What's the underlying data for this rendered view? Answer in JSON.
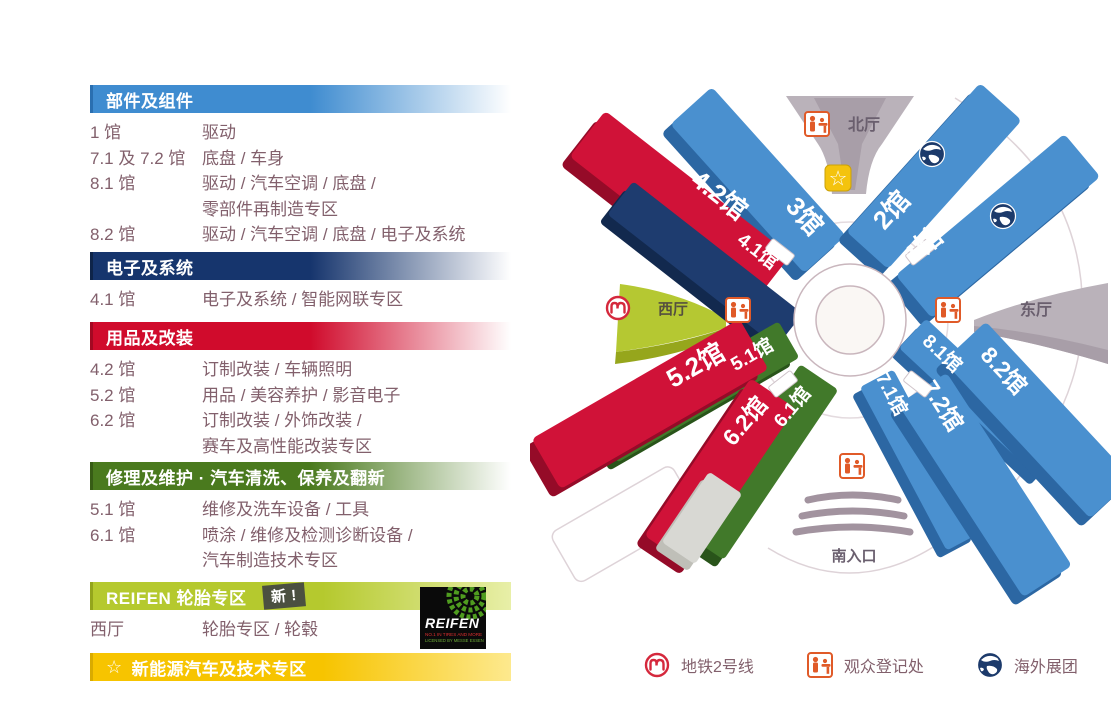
{
  "colors": {
    "blue": "#4a90cf",
    "navy": "#1e3c6f",
    "red": "#d01238",
    "green": "#41792a",
    "lime": "#b5c92e",
    "yellow": "#f7c400",
    "gray_hall": "#bab2ba",
    "body_text": "#82606c"
  },
  "legend": {
    "sections": [
      {
        "title": "部件及组件",
        "rows": [
          {
            "hall": "1 馆",
            "desc": "驱动"
          },
          {
            "hall": "7.1 及 7.2 馆",
            "desc": "底盘 / 车身"
          },
          {
            "hall": "8.1 馆",
            "desc": "驱动 / 汽车空调 / 底盘 /",
            "desc2": "零部件再制造专区"
          },
          {
            "hall": "8.2 馆",
            "desc": "驱动 / 汽车空调 / 底盘 / 电子及系统"
          }
        ]
      },
      {
        "title": "电子及系统",
        "rows": [
          {
            "hall": "4.1 馆",
            "desc": "电子及系统 / 智能网联专区"
          }
        ]
      },
      {
        "title": "用品及改装",
        "rows": [
          {
            "hall": "4.2 馆",
            "desc": "订制改装 / 车辆照明"
          },
          {
            "hall": "5.2 馆",
            "desc": "用品 / 美容养护 / 影音电子"
          },
          {
            "hall": "6.2 馆",
            "desc": "订制改装 / 外饰改装 /",
            "desc2": "赛车及高性能改装专区"
          }
        ]
      },
      {
        "title": "修理及维护 · 汽车清洗、保养及翻新",
        "rows": [
          {
            "hall": "5.1 馆",
            "desc": "维修及洗车设备 / 工具"
          },
          {
            "hall": "6.1 馆",
            "desc": "喷涂 / 维修及检测诊断设备 /",
            "desc2": "汽车制造技术专区"
          }
        ]
      },
      {
        "title": "REIFEN 轮胎专区",
        "badge": "新 !",
        "rows": [
          {
            "hall": "西厅",
            "desc": "轮胎专区 / 轮毂"
          }
        ]
      },
      {
        "title": "新能源汽车及技术专区",
        "star": "☆"
      }
    ]
  },
  "reifen_logo": {
    "brand": "REIFEN",
    "line1": "NO.1 IN TIRES AND MORE",
    "line2": "LICENSED BY MESSE ESSEN"
  },
  "map": {
    "star_symbol": "☆",
    "areas": {
      "north": "北厅",
      "east": "东厅",
      "west": "西厅",
      "south": "南入口"
    },
    "halls": [
      {
        "id": "3",
        "label": "3馆"
      },
      {
        "id": "4.2",
        "label": "4.2馆"
      },
      {
        "id": "4.1",
        "label": "4.1馆"
      },
      {
        "id": "2",
        "label": "2馆"
      },
      {
        "id": "1",
        "label": "1馆"
      },
      {
        "id": "5.1",
        "label": "5.1馆"
      },
      {
        "id": "5.2",
        "label": "5.2馆"
      },
      {
        "id": "6.1",
        "label": "6.1馆"
      },
      {
        "id": "6.2",
        "label": "6.2馆"
      },
      {
        "id": "8.1",
        "label": "8.1馆"
      },
      {
        "id": "8.2",
        "label": "8.2馆"
      },
      {
        "id": "7.1",
        "label": "7.1馆"
      },
      {
        "id": "7.2",
        "label": "7.2馆"
      }
    ]
  },
  "footer": {
    "items": [
      {
        "icon": "metro-icon",
        "label": "地铁2号线"
      },
      {
        "icon": "registration-icon",
        "label": "观众登记处"
      },
      {
        "icon": "globe-icon",
        "label": "海外展团"
      }
    ]
  }
}
